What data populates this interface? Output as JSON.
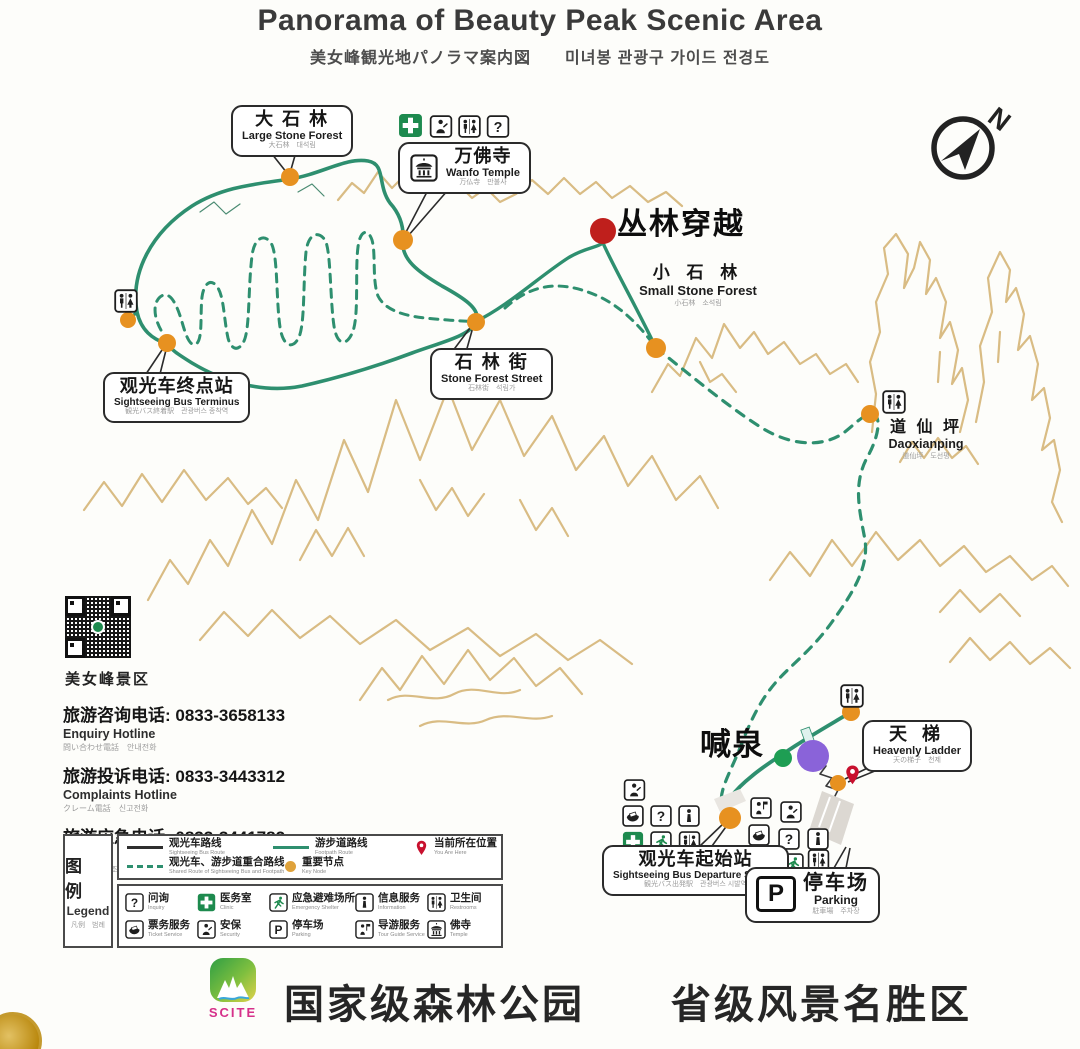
{
  "header": {
    "title": "Panorama of Beauty Peak Scenic Area",
    "subtitle": "美女峰観光地パノラマ案内図　　미녀봉 관광구 가이드 전경도"
  },
  "compass": {
    "label": "N"
  },
  "map": {
    "labels": {
      "large_stone_forest": {
        "zh": "大 石 林",
        "en": "Large Stone Forest",
        "sub": "大石林　대석림"
      },
      "wanfo_temple": {
        "zh": "万佛寺",
        "en": "Wanfo Temple",
        "sub": "万仏寺　만불사"
      },
      "small_stone_forest": {
        "zh": "小 石 林",
        "en": "Small Stone Forest",
        "sub": "小石林　소석림"
      },
      "stone_forest_street": {
        "zh": "石 林 街",
        "en": "Stone Forest Street",
        "sub": "石林街　석림가"
      },
      "bus_terminus": {
        "zh": "观光车终点站",
        "en": "Sightseeing Bus Terminus",
        "sub": "観光バス終着駅　관광버스 종착역"
      },
      "daoxianping": {
        "zh": "道 仙 坪",
        "en": "Daoxianping",
        "sub": "道仙坪　도선평"
      },
      "heavenly_ladder": {
        "zh": "天 梯",
        "en": "Heavenly Ladder",
        "sub": "天の梯子　천제"
      },
      "bus_departure": {
        "zh": "观光车起始站",
        "en": "Sightseeing Bus Departure Station",
        "sub": "観光バス出発駅　관광버스 시발역"
      },
      "parking": {
        "zh": "停车场",
        "en": "Parking",
        "sub": "駐車場　주차장"
      },
      "jungle_crossing": {
        "zh": "丛林穿越"
      },
      "shouting_spring": {
        "zh": "喊泉"
      }
    }
  },
  "info_panel": {
    "qr_caption": "美女峰景区",
    "hotlines": [
      {
        "zh": "旅游咨询电话: 0833-3658133",
        "en": "Enquiry Hotline",
        "sub": "問い合わせ電話　안내전화"
      },
      {
        "zh": "旅游投诉电话: 0833-3443312",
        "en": "Complaints Hotline",
        "sub": "クレーム電話　신고전화"
      },
      {
        "zh": "旅游应急电话: 0833-3441782",
        "en": "First Aid Call",
        "sub": "救援電話　구조전화"
      }
    ]
  },
  "legend": {
    "title_zh": "图 例",
    "title_en": "Legend",
    "title_sub": "凡例　범례",
    "routes": [
      {
        "zh": "观光车路线",
        "en": "Sightseeing Bus Route"
      },
      {
        "zh": "游步道路线",
        "en": "Footpath Route"
      },
      {
        "zh": "当前所在位置",
        "en": "You Are Here"
      },
      {
        "zh": "观光车、游步道重合路线",
        "en": "Shared Route of Sightseeing Bus and Footpath"
      },
      {
        "zh": "重要节点",
        "en": "Key Node"
      }
    ],
    "icons": [
      {
        "zh": "问询",
        "en": "Inquiry"
      },
      {
        "zh": "医务室",
        "en": "Clinic"
      },
      {
        "zh": "应急避难场所",
        "en": "Emergency Shelter"
      },
      {
        "zh": "信息服务",
        "en": "Information"
      },
      {
        "zh": "卫生间",
        "en": "Restrooms"
      },
      {
        "zh": "票务服务",
        "en": "Ticket Service"
      },
      {
        "zh": "安保",
        "en": "Security"
      },
      {
        "zh": "停车场",
        "en": "Parking"
      },
      {
        "zh": "导游服务",
        "en": "Tour Guide Service"
      },
      {
        "zh": "佛寺",
        "en": "Temple"
      }
    ]
  },
  "footer": {
    "logo_text": "SCITE",
    "slogan": "国家级森林公园　　省级风景名胜区"
  },
  "glyphs": {
    "question": "?",
    "parking": "P",
    "north": "N"
  },
  "colors": {
    "route_green": "#2E8F6F",
    "mountain_tan": "#D9BC84",
    "node_orange": "#E79120",
    "marker_red": "#BF1F1C",
    "marker_purple": "#8A63D9",
    "marker_green": "#1E9E53",
    "pin_red": "#C8102E",
    "medical_green": "#1D8A4E"
  }
}
